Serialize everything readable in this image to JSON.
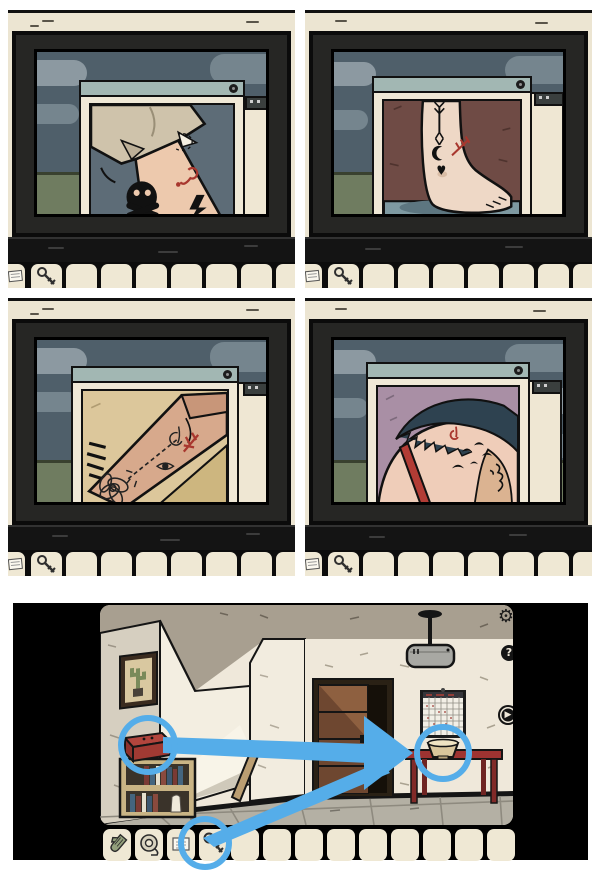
{
  "meta": {
    "description": "Collage of five puzzle-game screenshots: four TV close-ups of tattoo photos in popup windows, and one room scene with walkthrough annotations",
    "background": "#ffffff",
    "annotation_color": "#55ade9"
  },
  "top_panels": [
    {
      "id": "panel-1",
      "subject": "arm-tattoos-photo",
      "tattoos": [
        "paper-plane-with-dashed-loop",
        "skull-and-crossbones",
        "lightning-bolt",
        "red-note-symbol"
      ],
      "window": {
        "title_bar_color": "#a2b7b3",
        "close_icon": "close-icon"
      }
    },
    {
      "id": "panel-2",
      "subject": "foot-tattoos-photo",
      "tattoos": [
        "down-arrow",
        "crescent-moon",
        "heart",
        "red-arrow-symbol"
      ],
      "window": {
        "title_bar_color": "#a2b7b3",
        "close_icon": "close-icon"
      }
    },
    {
      "id": "panel-3",
      "subject": "wrist-tattoos-photo",
      "tattoos": [
        "lotus-flower",
        "dashed-arrow",
        "eye",
        "red-symbol",
        "feather-stripes"
      ],
      "window": {
        "title_bar_color": "#a2b7b3",
        "close_icon": "close-icon"
      }
    },
    {
      "id": "panel-4",
      "subject": "shoulder-tattoos-photo",
      "tattoos": [
        "flying-birds",
        "red-symbol",
        "face-profile-line-art"
      ],
      "window": {
        "title_bar_color": "#a2b7b3",
        "close_icon": "close-icon"
      }
    }
  ],
  "top_inventory": {
    "items": [
      "note",
      "key"
    ],
    "visible_empty_slots": 7
  },
  "room": {
    "hud": {
      "settings_icon": "⚙",
      "help_label": "?",
      "play_icon": "▶"
    },
    "objects": [
      "cactus-painting",
      "bookshelf",
      "red-box",
      "open-door",
      "leaning-plank",
      "wall-calendar",
      "ceiling-lamp",
      "red-table",
      "bowl"
    ],
    "inventory": {
      "items": [
        "glove",
        "tape-roll",
        "note",
        "key"
      ],
      "total_slots": 13
    },
    "annotations": {
      "color": "#55ade9",
      "circles": [
        "red-box",
        "bowl",
        "key-slot"
      ],
      "arrows": [
        {
          "from": "red-box",
          "to": "bowl"
        },
        {
          "from": "key-slot",
          "to": "bowl"
        }
      ]
    }
  },
  "palette": {
    "panel_wall": "#ece5d2",
    "tv_frame": "#262624",
    "sky": "#4f5f6a",
    "cloud_light": "#8c99a1",
    "cloud_mid": "#75858e",
    "hill": "#6f7c60",
    "slot": "#efe8d4",
    "room_wall": "#efe8da",
    "ceiling": "#a89f90",
    "door_wood": "#8e6040",
    "table_red": "#9e3331",
    "bowl_tan": "#d9c69c"
  }
}
